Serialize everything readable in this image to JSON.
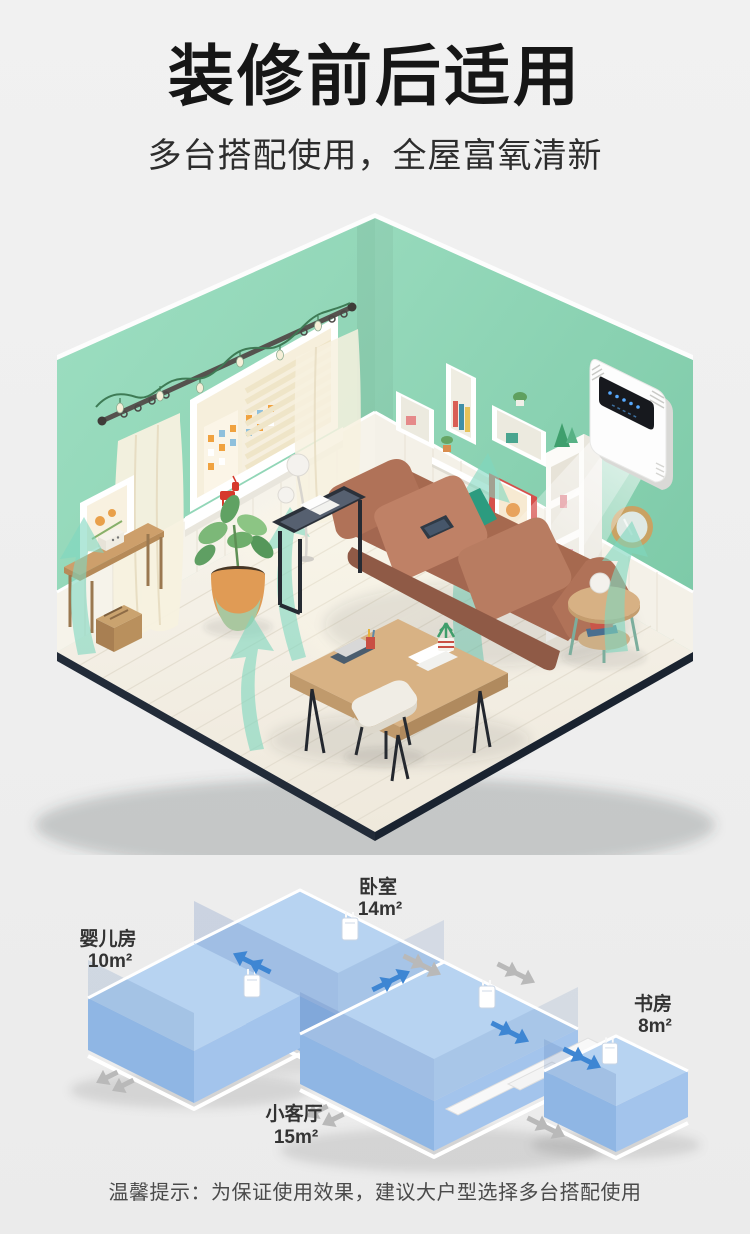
{
  "header": {
    "title": "装修前后适用",
    "subtitle": "多台搭配使用，全屋富氧清新"
  },
  "floorplan": {
    "rooms": [
      {
        "name": "卧室",
        "area": "14m²"
      },
      {
        "name": "婴儿房",
        "area": "10m²"
      },
      {
        "name": "书房",
        "area": "8m²"
      },
      {
        "name": "小客厅",
        "area": "15m²"
      }
    ]
  },
  "footer": {
    "tip": "温馨提示：为保证使用效果，建议大户型选择多台搭配使用"
  },
  "icons": {
    "airflow_arrow": "teal-curved-ribbon-arrow",
    "flow_arrow": "blue-double-arrow",
    "vent_arrow": "gray-double-arrow",
    "device": "wall-mounted-purifier"
  },
  "colors": {
    "background": "#efefef",
    "title_text": "#161616",
    "wall_green": "#92d6b8",
    "floor_cream": "#f5f1e7",
    "floorplan_blue": "#aecdef",
    "flow_blue": "#3e86d3",
    "vent_gray": "#b9b9b9",
    "airflow_teal": "#7fd7bf",
    "device_white": "#fdfdfd"
  }
}
